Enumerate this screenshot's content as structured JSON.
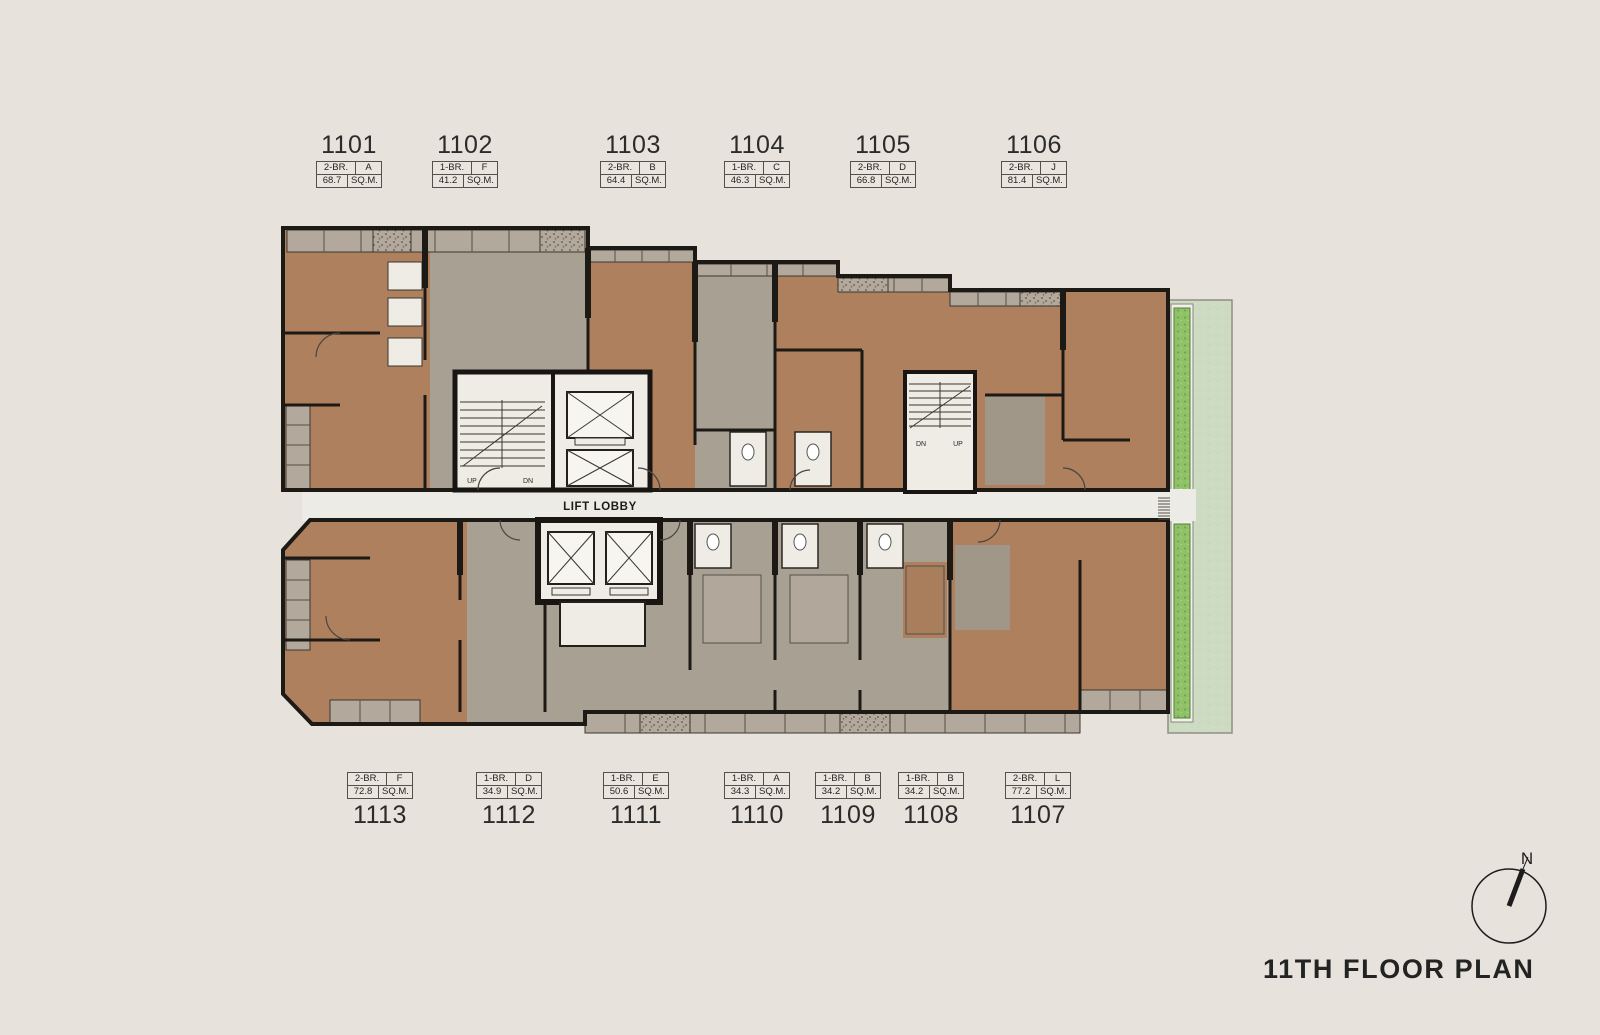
{
  "title": "11TH FLOOR PLAN",
  "compass": {
    "north_label": "N"
  },
  "lift_lobby_label": "LIFT LOBBY",
  "stair_labels": {
    "left_up": "UP",
    "left_dn": "DN",
    "right_dn": "DN",
    "right_up": "UP"
  },
  "units": [
    {
      "number": "1101",
      "type": "2-BR.",
      "variant": "A",
      "area": "68.7",
      "area_unit": "SQ.M."
    },
    {
      "number": "1102",
      "type": "1-BR.",
      "variant": "F",
      "area": "41.2",
      "area_unit": "SQ.M."
    },
    {
      "number": "1103",
      "type": "2-BR.",
      "variant": "B",
      "area": "64.4",
      "area_unit": "SQ.M."
    },
    {
      "number": "1104",
      "type": "1-BR.",
      "variant": "C",
      "area": "46.3",
      "area_unit": "SQ.M."
    },
    {
      "number": "1105",
      "type": "2-BR.",
      "variant": "D",
      "area": "66.8",
      "area_unit": "SQ.M."
    },
    {
      "number": "1106",
      "type": "2-BR.",
      "variant": "J",
      "area": "81.4",
      "area_unit": "SQ.M."
    },
    {
      "number": "1107",
      "type": "2-BR.",
      "variant": "L",
      "area": "77.2",
      "area_unit": "SQ.M."
    },
    {
      "number": "1108",
      "type": "1-BR.",
      "variant": "B",
      "area": "34.2",
      "area_unit": "SQ.M."
    },
    {
      "number": "1109",
      "type": "1-BR.",
      "variant": "B",
      "area": "34.2",
      "area_unit": "SQ.M."
    },
    {
      "number": "1110",
      "type": "1-BR.",
      "variant": "A",
      "area": "34.3",
      "area_unit": "SQ.M."
    },
    {
      "number": "1111",
      "type": "1-BR.",
      "variant": "E",
      "area": "50.6",
      "area_unit": "SQ.M."
    },
    {
      "number": "1112",
      "type": "1-BR.",
      "variant": "D",
      "area": "34.9",
      "area_unit": "SQ.M."
    },
    {
      "number": "1113",
      "type": "2-BR.",
      "variant": "F",
      "area": "72.8",
      "area_unit": "SQ.M."
    }
  ],
  "colors": {
    "unit_brown": "#ae805e",
    "unit_gray": "#a9a094",
    "corridor_white": "#efece6",
    "wall_black": "#1d1a16",
    "terrace_green": "#cddbc2",
    "planter_green": "#8fc167",
    "background": "#e7e3dc"
  }
}
